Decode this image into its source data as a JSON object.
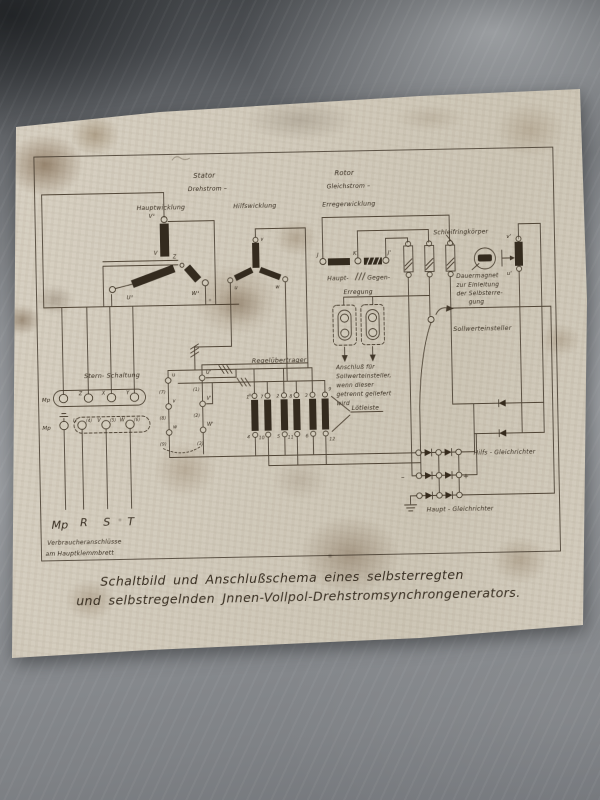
{
  "colors": {
    "paper": "#d6cfc0",
    "ink": "#3a3022",
    "surface": "#8b8e92"
  },
  "sections": {
    "stator": "Stator",
    "stator_current": "Drehstrom –",
    "rotor": "Rotor",
    "rotor_current": "Gleichstrom –"
  },
  "windings": {
    "haupt": "Hauptwicklung",
    "hilfs": "Hilfswicklung",
    "erreger": "Erregerwicklung"
  },
  "haupt_star": {
    "v1": "V¹",
    "v": "V",
    "z": "Z",
    "u1": "U¹",
    "w1": "W¹"
  },
  "hilfs_star": {
    "u": "u",
    "v": "v",
    "w": "w"
  },
  "exciter": {
    "j": "J",
    "k": "K",
    "j_prime": "J'",
    "haupt": "Haupt-",
    "gegen": "Gegen-",
    "erregung": "Erregung"
  },
  "slip_rings": {
    "label": "Schleifringkörper"
  },
  "dauermagnet": {
    "line1": "Dauermagnet",
    "line2": "zur Einleitung",
    "line3": "der Selbsterre-",
    "line4": "gung"
  },
  "sollwert": {
    "label": "Sollwerteinsteller"
  },
  "anschluss": {
    "line1": "Anschluß für",
    "line2": "Sollwerteinsteller,",
    "line3": "wenn dieser",
    "line4": "getrennt geliefert",
    "line5": "wird"
  },
  "regeluebertrager": {
    "label": "Regelübertrager",
    "top": [
      "1",
      "7",
      "2",
      "8",
      "3",
      "9"
    ],
    "bottom": [
      "4",
      "10",
      "5",
      "11",
      "6",
      "12"
    ]
  },
  "loetleiste": {
    "label": "Lötleiste"
  },
  "stern": {
    "label": "Stern- Schaltung",
    "mp": "Mp",
    "z": "Z",
    "x": "X",
    "y": "Y",
    "u": "U",
    "v": "V",
    "w": "W",
    "n4": "(4)",
    "n5": "(5)",
    "n6": "(6)"
  },
  "aux_terminals": {
    "u": "u",
    "n7": "(7)",
    "v": "v",
    "n8": "(8)",
    "w": "w",
    "n9": "(9)",
    "u1": "U'",
    "n1": "(1)",
    "v1": "V'",
    "n2": "(2)",
    "w1": "W'",
    "n3": "(3)"
  },
  "magnet_coil": {
    "top": "v'",
    "bottom": "u'"
  },
  "rectifier": {
    "hilfs": "Hilfs - Gleichrichter",
    "haupt": "Haupt - Gleichrichter",
    "minus": "–",
    "plus": "+"
  },
  "consumer": {
    "mp": "Mp",
    "r": "R",
    "s": "S",
    "t": "T",
    "note1": "Verbraucheranschlüsse",
    "note2": "am Hauptklemmbrett"
  },
  "caption": {
    "line1": "Schaltbild und Anschlußschema eines selbsterregten",
    "line2": "und selbstregelnden Jnnen-Vollpol-Drehstromsynchrongenerators."
  }
}
